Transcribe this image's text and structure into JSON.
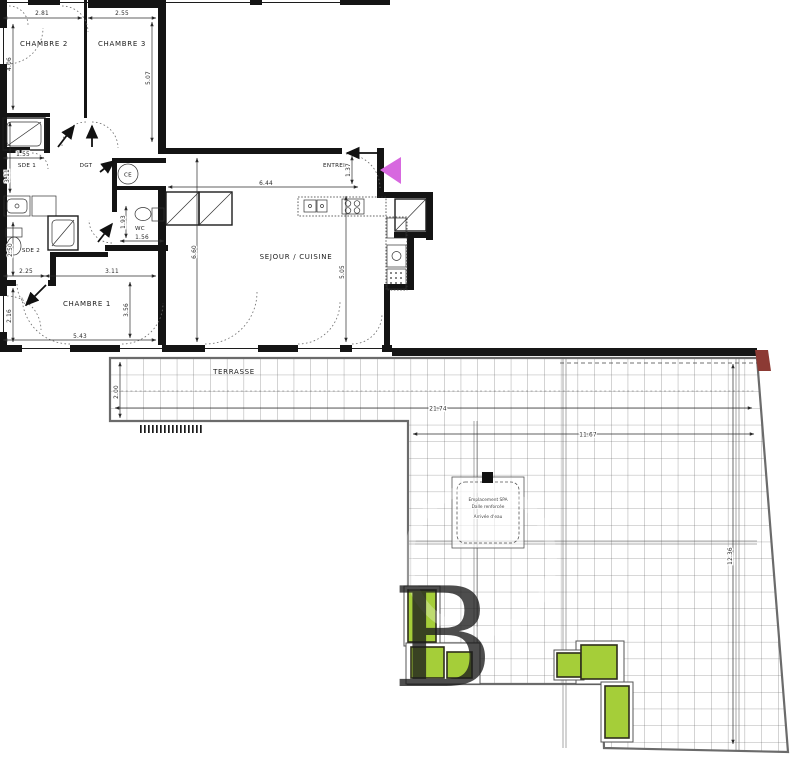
{
  "rooms": {
    "chambre2": "CHAMBRE 2",
    "chambre3": "CHAMBRE 3",
    "chambre1": "CHAMBRE 1",
    "sde1": "SDE 1",
    "sde2": "SDE 2",
    "wc": "WC",
    "dgt": "DGT",
    "ce": "CE",
    "entree": "ENTREE",
    "sejour": "SEJOUR / CUISINE",
    "terrasse": "TERRASSE"
  },
  "dims": {
    "top_ch2": "2.81",
    "top_ch3": "2.55",
    "ch2_h": "4.06",
    "ch3_h": "5.07",
    "sde1_w": "1.55",
    "sde1_h": "3.11",
    "sde2_h": "2.50",
    "wc_w": "1.56",
    "wc_h": "1.93",
    "ch1_small_w": "2.25",
    "ch1_w": "3.11",
    "ch1_h": "2.16",
    "ch1_bottom_w": "5.43",
    "ch1_right_h": "3.56",
    "sejour_w": "6.44",
    "entree_h": "1.37",
    "sejour_left_h": "6.60",
    "sejour_right_h": "5.05",
    "terrace_depth": "2.00",
    "terrace_total_w": "21.74",
    "terrace_lower_w": "11.67",
    "terrace_lower_h": "12.36"
  },
  "spa_note": {
    "line1": "Emplacement SPA",
    "line2": "Dalle renforcée",
    "line3": "Arrivée d'eau"
  },
  "watermark": "B",
  "colors": {
    "wall": "#141414",
    "planter_fill": "#a5ce39",
    "planter_border": "#2e2e1c",
    "entrance_marker": "#d768df",
    "accent_corner": "#8c3a34",
    "grid_line": "#5f5f5f",
    "boundary": "#6b6b6b",
    "dim_text": "#2b2b2b"
  }
}
